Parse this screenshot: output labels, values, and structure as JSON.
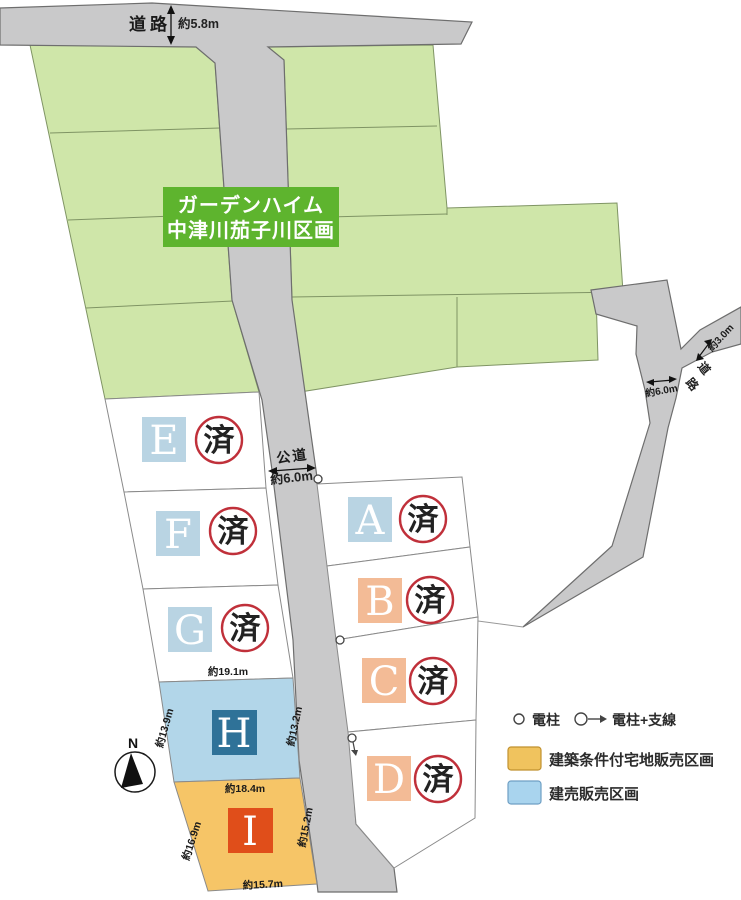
{
  "title_box": {
    "line1": "ガーデンハイム",
    "line2": "中津川茄子川区画"
  },
  "top_road": {
    "name": "道路",
    "width": "約5.8m"
  },
  "main_road": {
    "name": "公道",
    "width": "約6.0m"
  },
  "right_road": {
    "width": "約6.0m"
  },
  "branch_road": {
    "name": "道路",
    "char1": "道",
    "char2": "路",
    "width": "約3.0m"
  },
  "compass": {
    "north": "N"
  },
  "plots": [
    {
      "id": "A",
      "status": "済"
    },
    {
      "id": "B",
      "status": "済"
    },
    {
      "id": "C",
      "status": "済"
    },
    {
      "id": "D",
      "status": "済"
    },
    {
      "id": "E",
      "status": "済"
    },
    {
      "id": "F",
      "status": "済"
    },
    {
      "id": "G",
      "status": "済"
    },
    {
      "id": "H",
      "status": ""
    },
    {
      "id": "I",
      "status": ""
    }
  ],
  "dimensions": {
    "h_top": "約19.1m",
    "h_left": "約13.9m",
    "h_right": "約13.2m",
    "i_top": "約18.4m",
    "i_left": "約16.9m",
    "i_right": "約15.2m",
    "i_bottom": "約15.7m"
  },
  "legend": {
    "pole_label": "電柱",
    "pole_wire_label": "電柱+支線",
    "orange_label": "建築条件付宅地販売区画",
    "blue_label": "建売販売区画"
  },
  "colors": {
    "road": "#c9c9ca",
    "green": "#cfe6a9",
    "title_green": "#5eb42e",
    "chip_blue": "#b9d4e3",
    "chip_salmon": "#f3bb96",
    "h_fill": "#b2d6e9",
    "h_chip": "#2f7298",
    "i_fill": "#f6c567",
    "i_chip": "#e04e1a",
    "stamp_red": "#c0303a",
    "legend_orange": "#f0c35e",
    "legend_blue": "#a9d4ee"
  }
}
